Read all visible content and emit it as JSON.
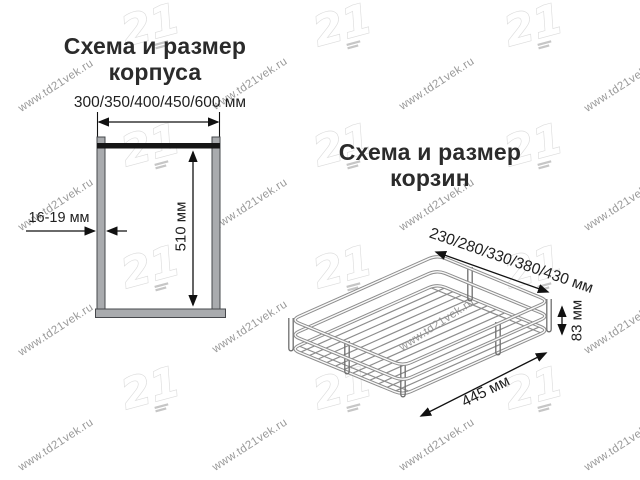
{
  "sections": {
    "korpus": {
      "title_line1": "Схема и размер",
      "title_line2": "корпуса",
      "width_dim": "300/350/400/450/600 мм",
      "height_dim": "510 мм",
      "thickness_dim": "16-19 мм"
    },
    "korzina": {
      "title_line1": "Схема и размер",
      "title_line2": "корзин",
      "width_dim": "230/280/330/380/430 мм",
      "height_dim": "83 мм",
      "length_dim": "445 мм"
    }
  },
  "watermark": {
    "text": "www.td21vek.ru",
    "logo": "21"
  },
  "colors": {
    "background": "#ffffff",
    "panel_fill": "#a9abae",
    "panel_border": "#46484c",
    "top_bar": "#161616",
    "dimension_line": "#111111",
    "wire": "#8d8d8d",
    "text": "#1f1f1f",
    "watermark_text": "#9a9a9a",
    "watermark_logo_stroke": "#dcdcdc"
  }
}
